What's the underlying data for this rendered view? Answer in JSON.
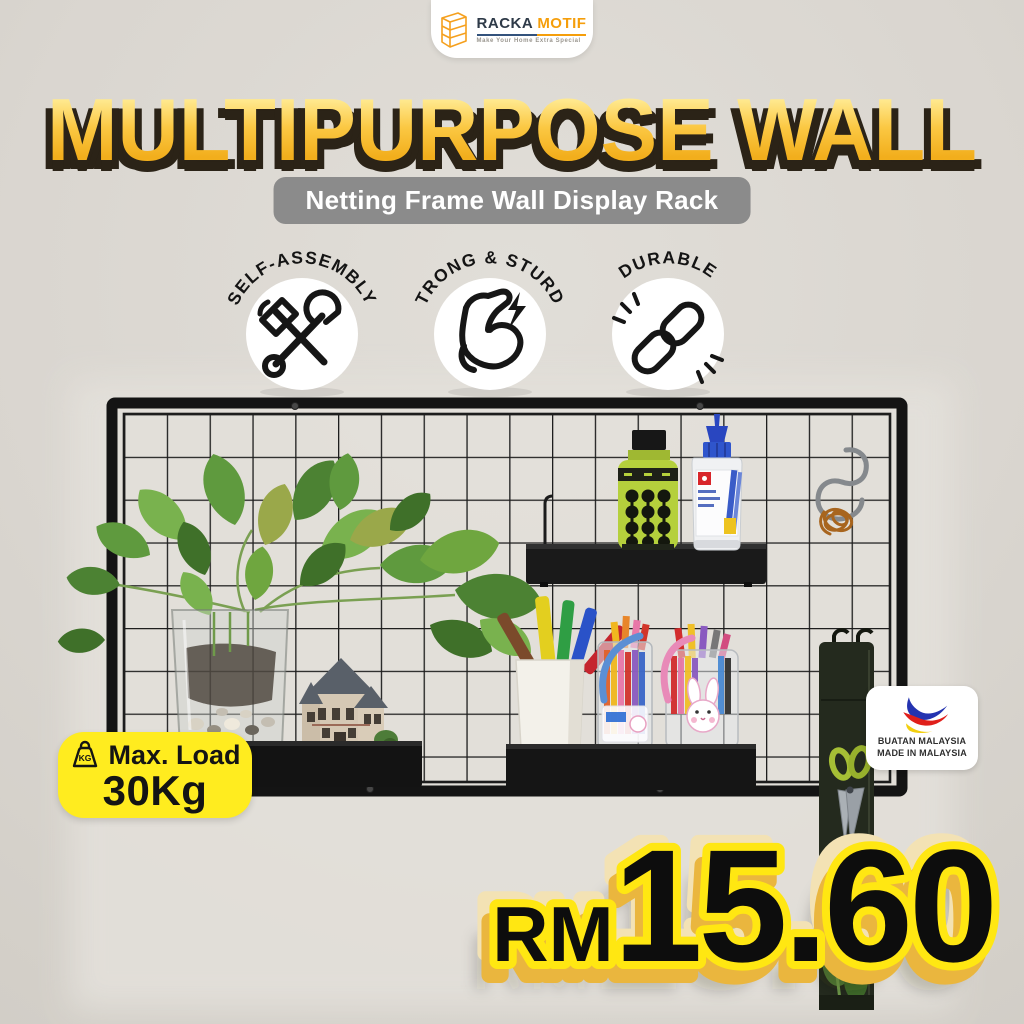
{
  "page": {
    "background_color": "#dcd8d2"
  },
  "logo": {
    "brand_primary": "RACKA",
    "brand_secondary": "MOTIF",
    "tagline": "Make Your Home Extra Special",
    "accent_color": "#f59e0b"
  },
  "headline": {
    "text": "MULTIPURPOSE WALL",
    "fill_top": "#fff7d6",
    "fill_bottom": "#f2ae1c",
    "shadow_color": "#2b2317"
  },
  "subtitle": {
    "text": "Netting Frame Wall Display Rack",
    "background_color": "#8b8b8b"
  },
  "feature_badges": [
    {
      "label": "SELF-ASSEMBLY",
      "icon": "hammer-wrench-icon"
    },
    {
      "label": "STRONG & STURDY",
      "icon": "bicep-lightning-icon"
    },
    {
      "label": "DURABLE",
      "icon": "chain-links-icon"
    }
  ],
  "max_load_badge": {
    "icon": "kg-weight-icon",
    "icon_text": "KG",
    "label": "Max. Load",
    "value": "30Kg",
    "background_color": "#ffec1f"
  },
  "origin_badge": {
    "icon": "buatan-malaysia-logo",
    "line1": "BUATAN MALAYSIA",
    "line2": "MADE IN MALAYSIA",
    "logo_colors": {
      "blue": "#2433b0",
      "red": "#e01f1b",
      "yellow": "#f2cf0e"
    }
  },
  "price": {
    "currency": "RM",
    "amount": "15.60",
    "text_color": "#0d0d0d",
    "outline_color": "#ffe712",
    "extrude_color": "#eab63e"
  },
  "product_photo": {
    "items": [
      "grid-netting-frame",
      "metal-shelf-tray",
      "spray-bottle",
      "glue-bottle",
      "s-hook",
      "copper-wire-coil",
      "pothos-plant",
      "glass-vase",
      "house-figurine",
      "pen-cup",
      "marker-pens",
      "pen-jars",
      "hanging-organizer",
      "scissors"
    ]
  }
}
